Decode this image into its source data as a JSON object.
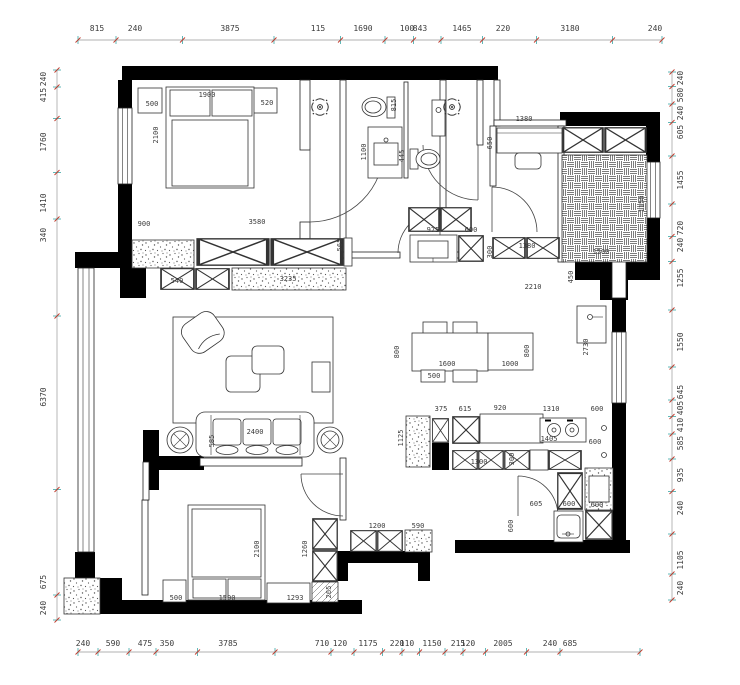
{
  "plan": {
    "type": "apartment-floor-plan",
    "units": "mm"
  },
  "colors": {
    "wall": "#000000",
    "furniture_line": "#333333",
    "dim_line": "#999999",
    "tick": "#3aa6a6",
    "tick_slash": "#c0392b",
    "dim_text": "#3b3b3b"
  },
  "dimensions": {
    "top": {
      "orient": "h",
      "line_pos": 40,
      "text_pos": 31,
      "start": 78,
      "end": 662,
      "labels": [
        {
          "t": "815",
          "p": 97
        },
        {
          "t": "240",
          "p": 135
        },
        {
          "t": "3875",
          "p": 230
        },
        {
          "t": "115",
          "p": 318
        },
        {
          "t": "1690",
          "p": 363
        },
        {
          "t": "100",
          "p": 407
        },
        {
          "t": "843",
          "p": 420
        },
        {
          "t": "1465",
          "p": 462
        },
        {
          "t": "220",
          "p": 503
        },
        {
          "t": "3180",
          "p": 570
        },
        {
          "t": "240",
          "p": 655
        }
      ]
    },
    "bottom": {
      "orient": "h",
      "line_pos": 652,
      "text_pos": 646,
      "start": 78,
      "end": 640,
      "labels": [
        {
          "t": "240",
          "p": 83
        },
        {
          "t": "590",
          "p": 113
        },
        {
          "t": "475",
          "p": 145
        },
        {
          "t": "350",
          "p": 167
        },
        {
          "t": "3785",
          "p": 228
        },
        {
          "t": "710",
          "p": 322
        },
        {
          "t": "120",
          "p": 340
        },
        {
          "t": "1175",
          "p": 368
        },
        {
          "t": "220",
          "p": 397
        },
        {
          "t": "110",
          "p": 407
        },
        {
          "t": "1150",
          "p": 432
        },
        {
          "t": "215",
          "p": 458
        },
        {
          "t": "120",
          "p": 468
        },
        {
          "t": "2005",
          "p": 503
        },
        {
          "t": "240",
          "p": 550
        },
        {
          "t": "685",
          "p": 570
        }
      ]
    },
    "left": {
      "orient": "v",
      "line_pos": 57,
      "text_pos": 46,
      "start": 70,
      "end": 620,
      "labels": [
        {
          "t": "240",
          "p": 79
        },
        {
          "t": "415",
          "p": 95
        },
        {
          "t": "1760",
          "p": 142
        },
        {
          "t": "1410",
          "p": 203
        },
        {
          "t": "340",
          "p": 235
        },
        {
          "t": "6370",
          "p": 397
        },
        {
          "t": "675",
          "p": 582
        },
        {
          "t": "240",
          "p": 608
        }
      ]
    },
    "right": {
      "orient": "v",
      "line_pos": 672,
      "text_pos": 683,
      "start": 72,
      "end": 600,
      "labels": [
        {
          "t": "240",
          "p": 78
        },
        {
          "t": "580",
          "p": 95
        },
        {
          "t": "240",
          "p": 113
        },
        {
          "t": "605",
          "p": 132
        },
        {
          "t": "1455",
          "p": 180
        },
        {
          "t": "720",
          "p": 228
        },
        {
          "t": "240",
          "p": 245
        },
        {
          "t": "1255",
          "p": 278
        },
        {
          "t": "1550",
          "p": 342
        },
        {
          "t": "645",
          "p": 392
        },
        {
          "t": "405",
          "p": 408
        },
        {
          "t": "410",
          "p": 425
        },
        {
          "t": "585",
          "p": 443
        },
        {
          "t": "935",
          "p": 475
        },
        {
          "t": "240",
          "p": 508
        },
        {
          "t": "1105",
          "p": 560
        },
        {
          "t": "240",
          "p": 588
        }
      ]
    }
  },
  "interior_labels": [
    {
      "t": "500",
      "x": 152,
      "y": 106
    },
    {
      "t": "1900",
      "x": 207,
      "y": 97
    },
    {
      "t": "520",
      "x": 267,
      "y": 105
    },
    {
      "t": "2100",
      "x": 158,
      "y": 135,
      "r": 1
    },
    {
      "t": "900",
      "x": 144,
      "y": 226
    },
    {
      "t": "3580",
      "x": 257,
      "y": 224
    },
    {
      "t": "565",
      "x": 342,
      "y": 245,
      "r": 1
    },
    {
      "t": "540",
      "x": 177,
      "y": 283
    },
    {
      "t": "3235",
      "x": 288,
      "y": 281
    },
    {
      "t": "815",
      "x": 396,
      "y": 105,
      "r": 1
    },
    {
      "t": "1100",
      "x": 366,
      "y": 152,
      "r": 1
    },
    {
      "t": "445",
      "x": 404,
      "y": 156,
      "r": 1
    },
    {
      "t": "1380",
      "x": 524,
      "y": 121
    },
    {
      "t": "650",
      "x": 492,
      "y": 143,
      "r": 1
    },
    {
      "t": "975",
      "x": 433,
      "y": 232
    },
    {
      "t": "600",
      "x": 471,
      "y": 232
    },
    {
      "t": "1380",
      "x": 527,
      "y": 248
    },
    {
      "t": "300",
      "x": 492,
      "y": 252,
      "r": 1
    },
    {
      "t": "1150",
      "x": 644,
      "y": 204,
      "r": 1
    },
    {
      "t": "1500",
      "x": 601,
      "y": 254
    },
    {
      "t": "2210",
      "x": 533,
      "y": 289
    },
    {
      "t": "450",
      "x": 573,
      "y": 277,
      "r": 1
    },
    {
      "t": "2400",
      "x": 255,
      "y": 434
    },
    {
      "t": "585",
      "x": 214,
      "y": 441,
      "r": 1
    },
    {
      "t": "800",
      "x": 399,
      "y": 352,
      "r": 1
    },
    {
      "t": "1600",
      "x": 447,
      "y": 366
    },
    {
      "t": "500",
      "x": 434,
      "y": 378
    },
    {
      "t": "1000",
      "x": 510,
      "y": 366
    },
    {
      "t": "800",
      "x": 529,
      "y": 351,
      "r": 1
    },
    {
      "t": "2730",
      "x": 588,
      "y": 347,
      "r": 1
    },
    {
      "t": "375",
      "x": 441,
      "y": 411
    },
    {
      "t": "615",
      "x": 465,
      "y": 411
    },
    {
      "t": "920",
      "x": 500,
      "y": 410
    },
    {
      "t": "1310",
      "x": 551,
      "y": 411
    },
    {
      "t": "600",
      "x": 597,
      "y": 411
    },
    {
      "t": "1125",
      "x": 403,
      "y": 438,
      "r": 1
    },
    {
      "t": "1405",
      "x": 549,
      "y": 441
    },
    {
      "t": "600",
      "x": 595,
      "y": 444
    },
    {
      "t": "1300",
      "x": 479,
      "y": 464
    },
    {
      "t": "300",
      "x": 514,
      "y": 459,
      "r": 1
    },
    {
      "t": "605",
      "x": 536,
      "y": 506
    },
    {
      "t": "600",
      "x": 569,
      "y": 506
    },
    {
      "t": "600",
      "x": 597,
      "y": 507
    },
    {
      "t": "600",
      "x": 513,
      "y": 526,
      "r": 1
    },
    {
      "t": "590",
      "x": 418,
      "y": 528
    },
    {
      "t": "1200",
      "x": 377,
      "y": 528
    },
    {
      "t": "2100",
      "x": 259,
      "y": 549,
      "r": 1
    },
    {
      "t": "1260",
      "x": 307,
      "y": 549,
      "r": 1
    },
    {
      "t": "500",
      "x": 176,
      "y": 600
    },
    {
      "t": "1500",
      "x": 227,
      "y": 600
    },
    {
      "t": "1293",
      "x": 295,
      "y": 600
    },
    {
      "t": "265",
      "x": 331,
      "y": 592,
      "r": 1
    }
  ]
}
